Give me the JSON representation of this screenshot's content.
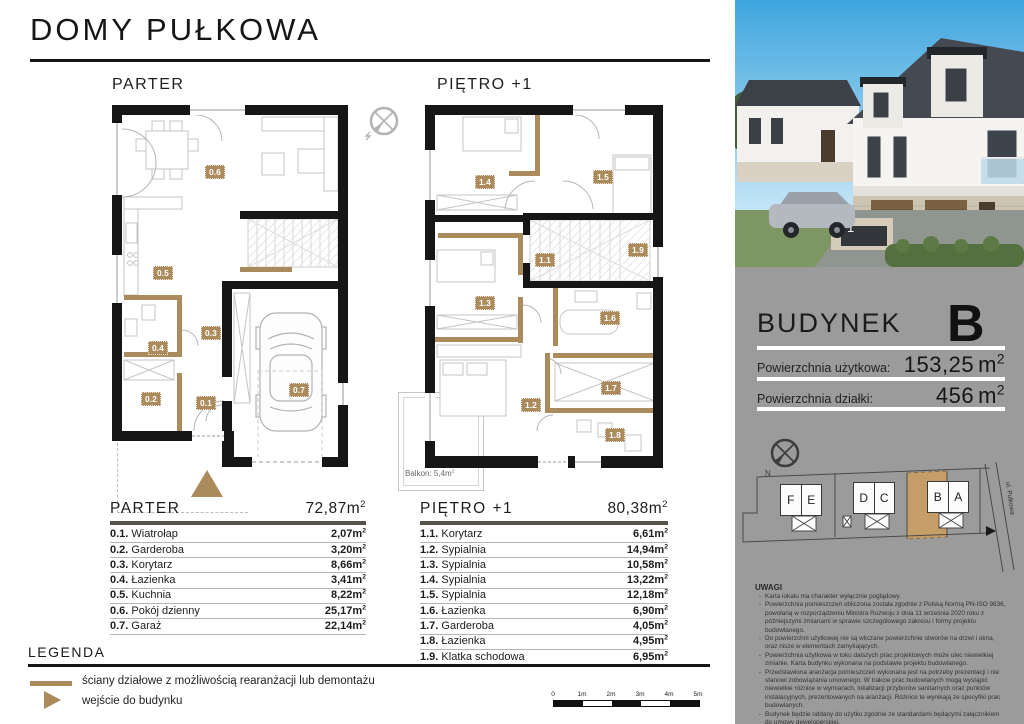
{
  "header": {
    "title": "DOMY PUŁKOWA"
  },
  "units": {
    "m": "m",
    "sq": "2"
  },
  "compass": {
    "n": "N"
  },
  "floors": {
    "parter": {
      "label": "PARTER",
      "total": "72,87",
      "badges": [
        "0.1",
        "0.2",
        "0.3",
        "0.4",
        "0.5",
        "0.6",
        "0.7"
      ],
      "rooms": [
        {
          "num": "0.1.",
          "name": "Wiatrołap",
          "area": "2,07"
        },
        {
          "num": "0.2.",
          "name": "Garderoba",
          "area": "3,20"
        },
        {
          "num": "0.3.",
          "name": "Korytarz",
          "area": "8,66"
        },
        {
          "num": "0.4.",
          "name": "Łazienka",
          "area": "3,41"
        },
        {
          "num": "0.5.",
          "name": "Kuchnia",
          "area": "8,22"
        },
        {
          "num": "0.6.",
          "name": "Pokój dzienny",
          "area": "25,17"
        },
        {
          "num": "0.7.",
          "name": "Garaż",
          "area": "22,14"
        }
      ]
    },
    "pietro": {
      "label": "PIĘTRO +1",
      "total": "80,38",
      "badges": [
        "1.1",
        "1.2",
        "1.3",
        "1.4",
        "1.5",
        "1.6",
        "1.7",
        "1.8",
        "1.9"
      ],
      "balkon": "Balkon: 5,4m",
      "rooms": [
        {
          "num": "1.1.",
          "name": "Korytarz",
          "area": "6,61"
        },
        {
          "num": "1.2.",
          "name": "Sypialnia",
          "area": "14,94"
        },
        {
          "num": "1.3.",
          "name": "Sypialnia",
          "area": "10,58"
        },
        {
          "num": "1.4.",
          "name": "Sypialnia",
          "area": "13,22"
        },
        {
          "num": "1.5.",
          "name": "Sypialnia",
          "area": "12,18"
        },
        {
          "num": "1.6.",
          "name": "Łazienka",
          "area": "6,90"
        },
        {
          "num": "1.7.",
          "name": "Garderoba",
          "area": "4,05"
        },
        {
          "num": "1.8.",
          "name": "Łazienka",
          "area": "4,95"
        },
        {
          "num": "1.9.",
          "name": "Klatka schodowa",
          "area": "6,95"
        }
      ]
    }
  },
  "legend": {
    "title": "LEGENDA",
    "items": [
      {
        "label": "ściany działowe z możliwością rearanżacji lub demontażu"
      },
      {
        "label": "wejście do budynku"
      }
    ]
  },
  "scalebar": {
    "labels": [
      "0",
      "1m",
      "2m",
      "3m",
      "4m",
      "5m"
    ]
  },
  "photo": {
    "address_number": "1"
  },
  "sidebar": {
    "building": {
      "label": "BUDYNEK",
      "letter": "B",
      "rows": [
        {
          "label": "Powierzchnia użytkowa:",
          "value": "153,25"
        },
        {
          "label": "Powierzchnia działki:",
          "value": "456"
        }
      ]
    },
    "sitemap": {
      "street": "ul. Pułkowa",
      "pairs": [
        [
          "F",
          "E"
        ],
        [
          "D",
          "C"
        ],
        [
          "B",
          "A"
        ]
      ]
    },
    "uwagi": {
      "title": "UWAGI",
      "bullet": "-",
      "items": [
        "Karta lokalu ma charakter wyłącznie poglądowy.",
        "Powierzchnia pomieszczeń obliczona została zgodnie z Polską Normą PN-ISO 9836, powołaną w rozporządzeniu Ministra Rozwoju z dnia 11 września 2020 roku z późniejszymi zmianami w sprawie szczegółowego zakresu i formy projektu budowlanego.",
        "Do powierzchni użytkowej nie są wliczane powierzchnie otworów na drzwi i okna, oraz nisze w elementach zamykających.",
        "Powierzchnia użytkowa w toku dalszych prac projektowych może ulec niewielkiej zmianie. Karta budynku wykonana na podstawie projektu budowlanego.",
        "Przedstawiona aranżacja pomieszczeń wykonana jest na potrzeby prezentacji i nie stanowi zobowiązania umownego. W trakcie prac budowlanych mogą wystąpić niewielkie różnice w wymiarach, lokalizacji przyborów sanitarnych oraz punktów instalacyjnych, prezentowanych na aranżacji. Różnice te wynikają ze specyfiki prac budowlanych.",
        "Budynek będzie oddany do użytku zgodnie ze standardami będącymi załącznikiem do umowy deweloperskiej.",
        "Naruszenie elementów konstrukcyjnych jest zabronione."
      ]
    }
  },
  "colors": {
    "tan": "#ab8a5c",
    "tanLight": "#c59d68",
    "sidebar": "#9b9b9b",
    "wall": "#161616",
    "headerRule": "#56524a"
  }
}
